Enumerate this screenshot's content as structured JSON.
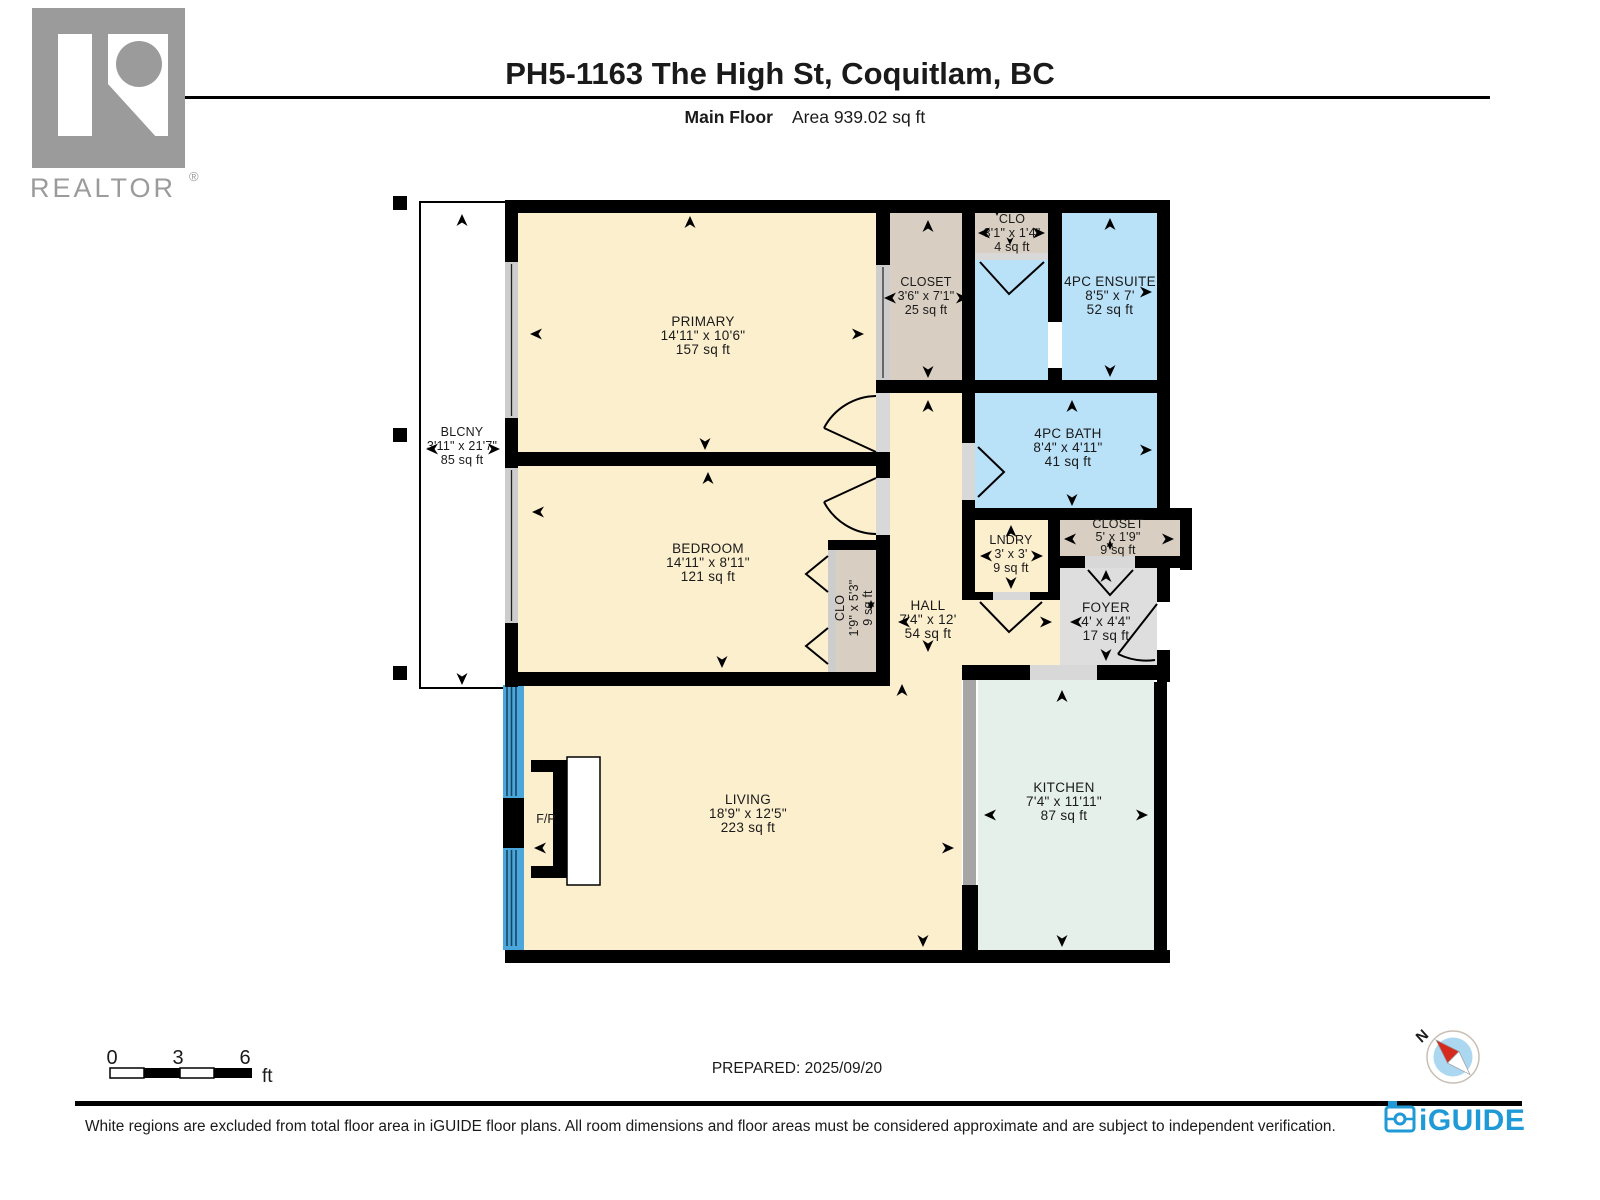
{
  "header": {
    "title": "PH5-1163 The High St, Coquitlam, BC",
    "floor_label": "Main Floor",
    "area_label": "Area 939.02 sq ft"
  },
  "realtor_logo": {
    "wordmark": "REALTOR",
    "registered": "®"
  },
  "rooms": {
    "primary": {
      "name": "PRIMARY",
      "dims": "14'11\" x 10'6\"",
      "area": "157 sq ft"
    },
    "bedroom": {
      "name": "BEDROOM",
      "dims": "14'11\" x 8'11\"",
      "area": "121 sq ft"
    },
    "closet_top": {
      "name": "CLOSET",
      "dims": "3'6\" x 7'1\"",
      "area": "25 sq ft"
    },
    "clo_top": {
      "name": "CLO",
      "dims": "3'1\" x 1'4\"",
      "area": "4 sq ft"
    },
    "ensuite": {
      "name": "4PC ENSUITE",
      "dims": "8'5\" x 7'",
      "area": "52 sq ft"
    },
    "bath": {
      "name": "4PC BATH",
      "dims": "8'4\" x 4'11\"",
      "area": "41 sq ft"
    },
    "lndry": {
      "name": "LNDRY",
      "dims": "3' x 3'",
      "area": "9 sq ft"
    },
    "closet_right": {
      "name": "CLOSET",
      "dims": "5' x 1'9\"",
      "area": "9 sq ft"
    },
    "foyer": {
      "name": "FOYER",
      "dims": "4' x 4'4\"",
      "area": "17 sq ft"
    },
    "hall": {
      "name": "HALL",
      "dims": "7'4\" x 12'",
      "area": "54 sq ft"
    },
    "clo_bedroom": {
      "name": "CLO",
      "dims": "1'9\" x 5'3\"",
      "area": "9 sq ft"
    },
    "living": {
      "name": "LIVING",
      "dims": "18'9\" x 12'5\"",
      "area": "223 sq ft"
    },
    "kitchen": {
      "name": "KITCHEN",
      "dims": "7'4\" x 11'11\"",
      "area": "87 sq ft"
    },
    "balcony": {
      "name": "BLCNY",
      "dims": "3'11\" x 21'7\"",
      "area": "85 sq ft"
    },
    "fireplace": {
      "label": "F/P"
    }
  },
  "scale_bar": {
    "tick0": "0",
    "tick3": "3",
    "tick6": "6",
    "unit": "ft"
  },
  "prepared": "PREPARED: 2025/09/20",
  "compass": {
    "north_label": "N"
  },
  "footer": {
    "disclaimer": "White regions are excluded from total floor area in iGUIDE floor plans. All room dimensions and floor areas must be considered approximate and are subject to independent verification.",
    "brand": "iGUIDE"
  },
  "colors": {
    "wall": "#000000",
    "room_cream": "#FCEFCE",
    "room_tan": "#D8CFC2",
    "room_blue": "#B9E1F8",
    "room_green": "#E4F0E9",
    "room_gray": "#DEDEDE",
    "threshold_gray": "#D8D8D8",
    "window_gray": "#CDCDCD",
    "window_blue": "#4BA6DC",
    "divider_gray": "#A5A5A5",
    "balcony_white": "#FFFFFF",
    "iguide_blue": "#1F9AD6",
    "realtor_gray": "#9B9B9B",
    "compass_red": "#D42B1E"
  }
}
